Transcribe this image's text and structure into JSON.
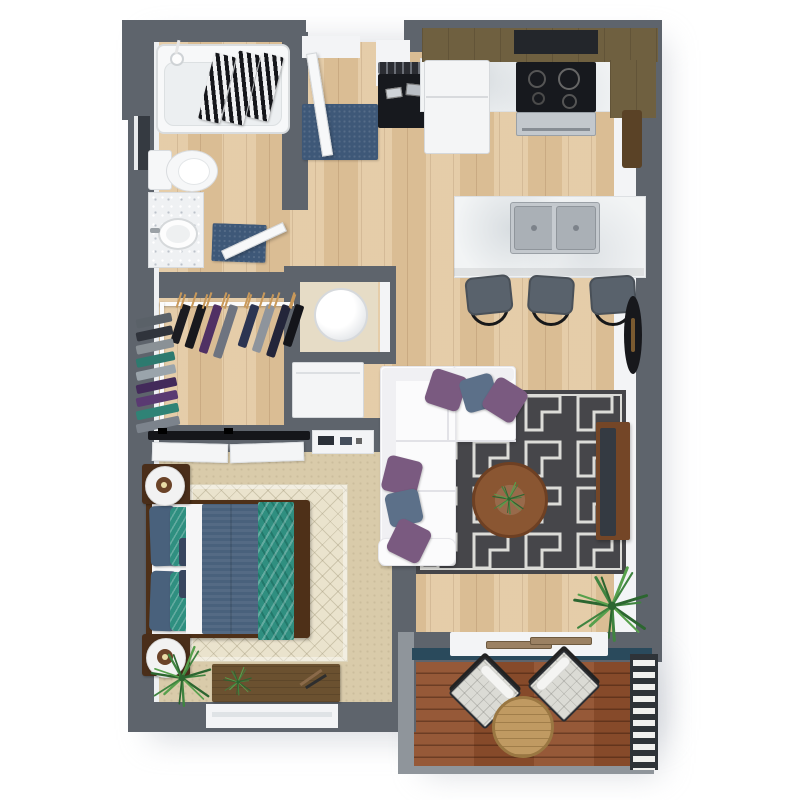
{
  "scene": {
    "title": "3D top-down floor plan of a one-bedroom apartment",
    "style": "photorealistic render, no text labels",
    "rooms": [
      "bathroom",
      "walk-in closet",
      "entry hall",
      "kitchen",
      "living room",
      "bedroom",
      "utility closets",
      "balcony"
    ]
  },
  "colors": {
    "wall": "#5e646c",
    "wall-light": "#8f959b",
    "baseboard": "#f3f4f6",
    "floor-wood": "#e2c79f",
    "carpet": "#d9cbaa",
    "rug-bedroom": "#eae3cd",
    "rug-living": "#46464a",
    "rug-living-pattern": "#dcdcd8",
    "deck": "#90502d",
    "teal-band": "#2a4a5c",
    "railing-dark": "#2e3338",
    "counter": "#f2f4f5",
    "cabinet": "#6f6040",
    "cabinet-dark": "#23262b",
    "white-goods": "#f4f5f6",
    "steel": "#c3c8cd",
    "black": "#17191e",
    "sofa": "#fbfbfc",
    "pillow-purple": "#7a5a80",
    "pillow-blue": "#5c7089",
    "pillow-navy": "#38465f",
    "table-wood": "#8a5632",
    "tv-wood": "#744627",
    "tv-screen": "#343a42",
    "bed-frame": "#4e3018",
    "duvet": "#49617c",
    "throw-teal": "#2f8f80",
    "sheet": "#f6f6f7",
    "nightstand": "#4a2e1a",
    "lamp-inner": "#6b4328",
    "desk-wood": "#6b5130",
    "plant": "#3f8440",
    "plant-dark": "#2c6630",
    "plant-light": "#57a04c",
    "mat-blue": "#3e5878",
    "stool": "#59626c",
    "chair-cushion": "#dbdbd5",
    "balcony-table": "#c09a62",
    "glass": "#9b8163",
    "hanger": "#c9995a"
  },
  "bathroom": {
    "fixtures": [
      "bathtub",
      "striped towels",
      "shower control",
      "toilet",
      "vanity with sink",
      "wall mirror",
      "blue bath mat",
      "door"
    ]
  },
  "closet": {
    "top_garments": [
      "#1b1c21",
      "#17181d",
      "#503064",
      "#6e7480",
      "#2c3552",
      "#8e949c",
      "#23253a",
      "#14151a"
    ],
    "left_garments": [
      "#5a6168",
      "#30343c",
      "#8a9196",
      "#2d7a6f",
      "#9aa4ab",
      "#432a5a",
      "#5a3a72",
      "#2f8376",
      "#7c838c"
    ],
    "bare_hangers": 6
  },
  "kitchen": {
    "appliances": [
      "entry coat console",
      "refrigerator",
      "range with cooktop",
      "upper cabinets",
      "island with double sink"
    ],
    "stools": 3
  },
  "living": {
    "furniture": [
      "white sectional sofa",
      "geometric maze rug",
      "round coffee table with plant",
      "tv console with tv",
      "floor plant",
      "wall decor shelf",
      "oval wall decor"
    ],
    "sofa_pillows": [
      {
        "color": "#7a5a80",
        "x": 428,
        "y": 372,
        "s": 36,
        "r": 18
      },
      {
        "color": "#5c7089",
        "x": 462,
        "y": 376,
        "s": 34,
        "r": -16
      },
      {
        "color": "#7a5a80",
        "x": 487,
        "y": 382,
        "s": 36,
        "r": 32
      },
      {
        "color": "#7a5a80",
        "x": 384,
        "y": 458,
        "s": 36,
        "r": 14
      },
      {
        "color": "#5c7089",
        "x": 387,
        "y": 491,
        "s": 34,
        "r": -12
      },
      {
        "color": "#7a5a80",
        "x": 391,
        "y": 523,
        "s": 36,
        "r": 26
      }
    ]
  },
  "bedroom": {
    "furniture": [
      "platform bed with blue duvet and teal chevron throw",
      "two nightstands with round lamps",
      "sliding closet doors",
      "media shelf",
      "desk dresser with plant",
      "corner palm plant",
      "window",
      "diamond rug"
    ]
  },
  "utility": {
    "items": [
      "water heater closet",
      "washer-dryer nook"
    ]
  },
  "balcony": {
    "furniture": [
      "plank decking",
      "two quilted lounge chairs",
      "round slat table",
      "ladder railing",
      "sliding glass door"
    ],
    "chairs": 2
  },
  "plants": {
    "leaf_count": 14
  }
}
